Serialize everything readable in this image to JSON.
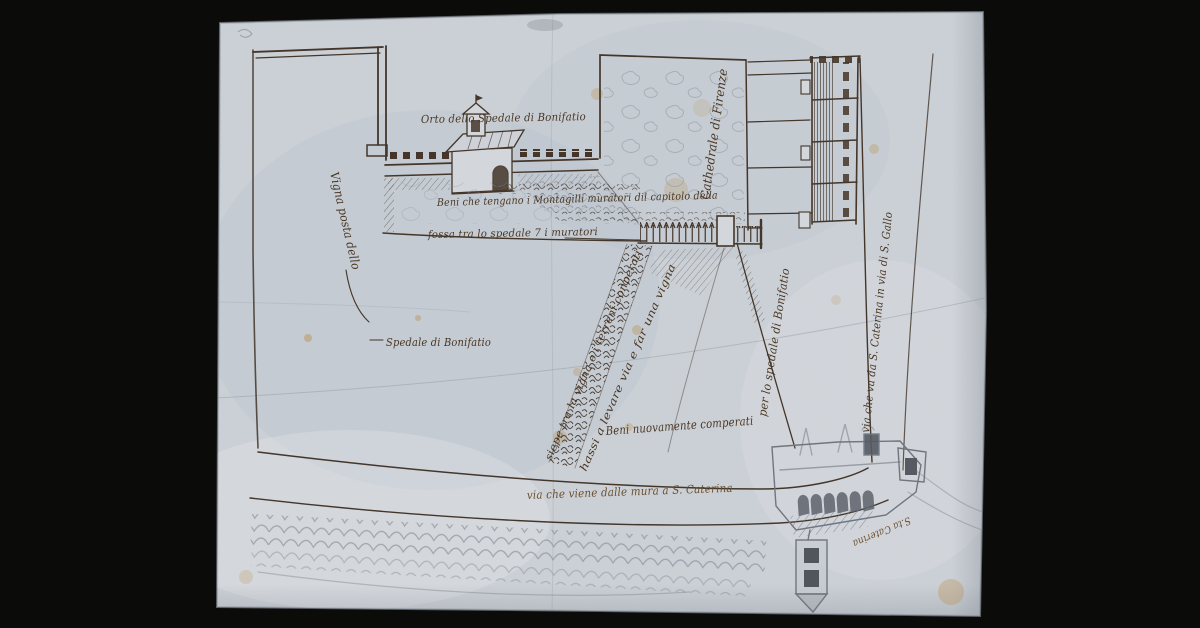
{
  "colors": {
    "background": "#0b0b0a",
    "paper": "#ccd1d7",
    "ink": "#44362a",
    "ink_brown": "#6b4f2e",
    "graphite": "#767d88",
    "stain": "#ba8d4a"
  },
  "labels": {
    "orto": {
      "text": "Orto dello Spedale di Bonifatio"
    },
    "cathedrale": {
      "text": "Cathedrale di Firenze"
    },
    "beni_muratori": {
      "text": "Beni che tengano i Montagilli muratori dil capitolo della"
    },
    "fossa": {
      "text": "fossa tra lo spedale 7 i muratori"
    },
    "vigna": {
      "text": "Vigna posta dello"
    },
    "spedale": {
      "text": "Spedale di Bonifatio"
    },
    "siepe_1": {
      "text": "siepe tra la vigna e i terreni conperati"
    },
    "siepe_2": {
      "text": "hassi a levare via e far una vigna"
    },
    "per_lo_spedale": {
      "text": "per lo spedale di Bonifatio"
    },
    "beni_comperati": {
      "text": "Beni nuovamente comperati"
    },
    "via_mura": {
      "text": "via che viene dalle mura a S. Caterina"
    },
    "via_s_gallo": {
      "text": "via che va da S. Caterina in via di S. Gallo"
    },
    "s_caterina": {
      "text": "S.ta Caterina"
    }
  }
}
